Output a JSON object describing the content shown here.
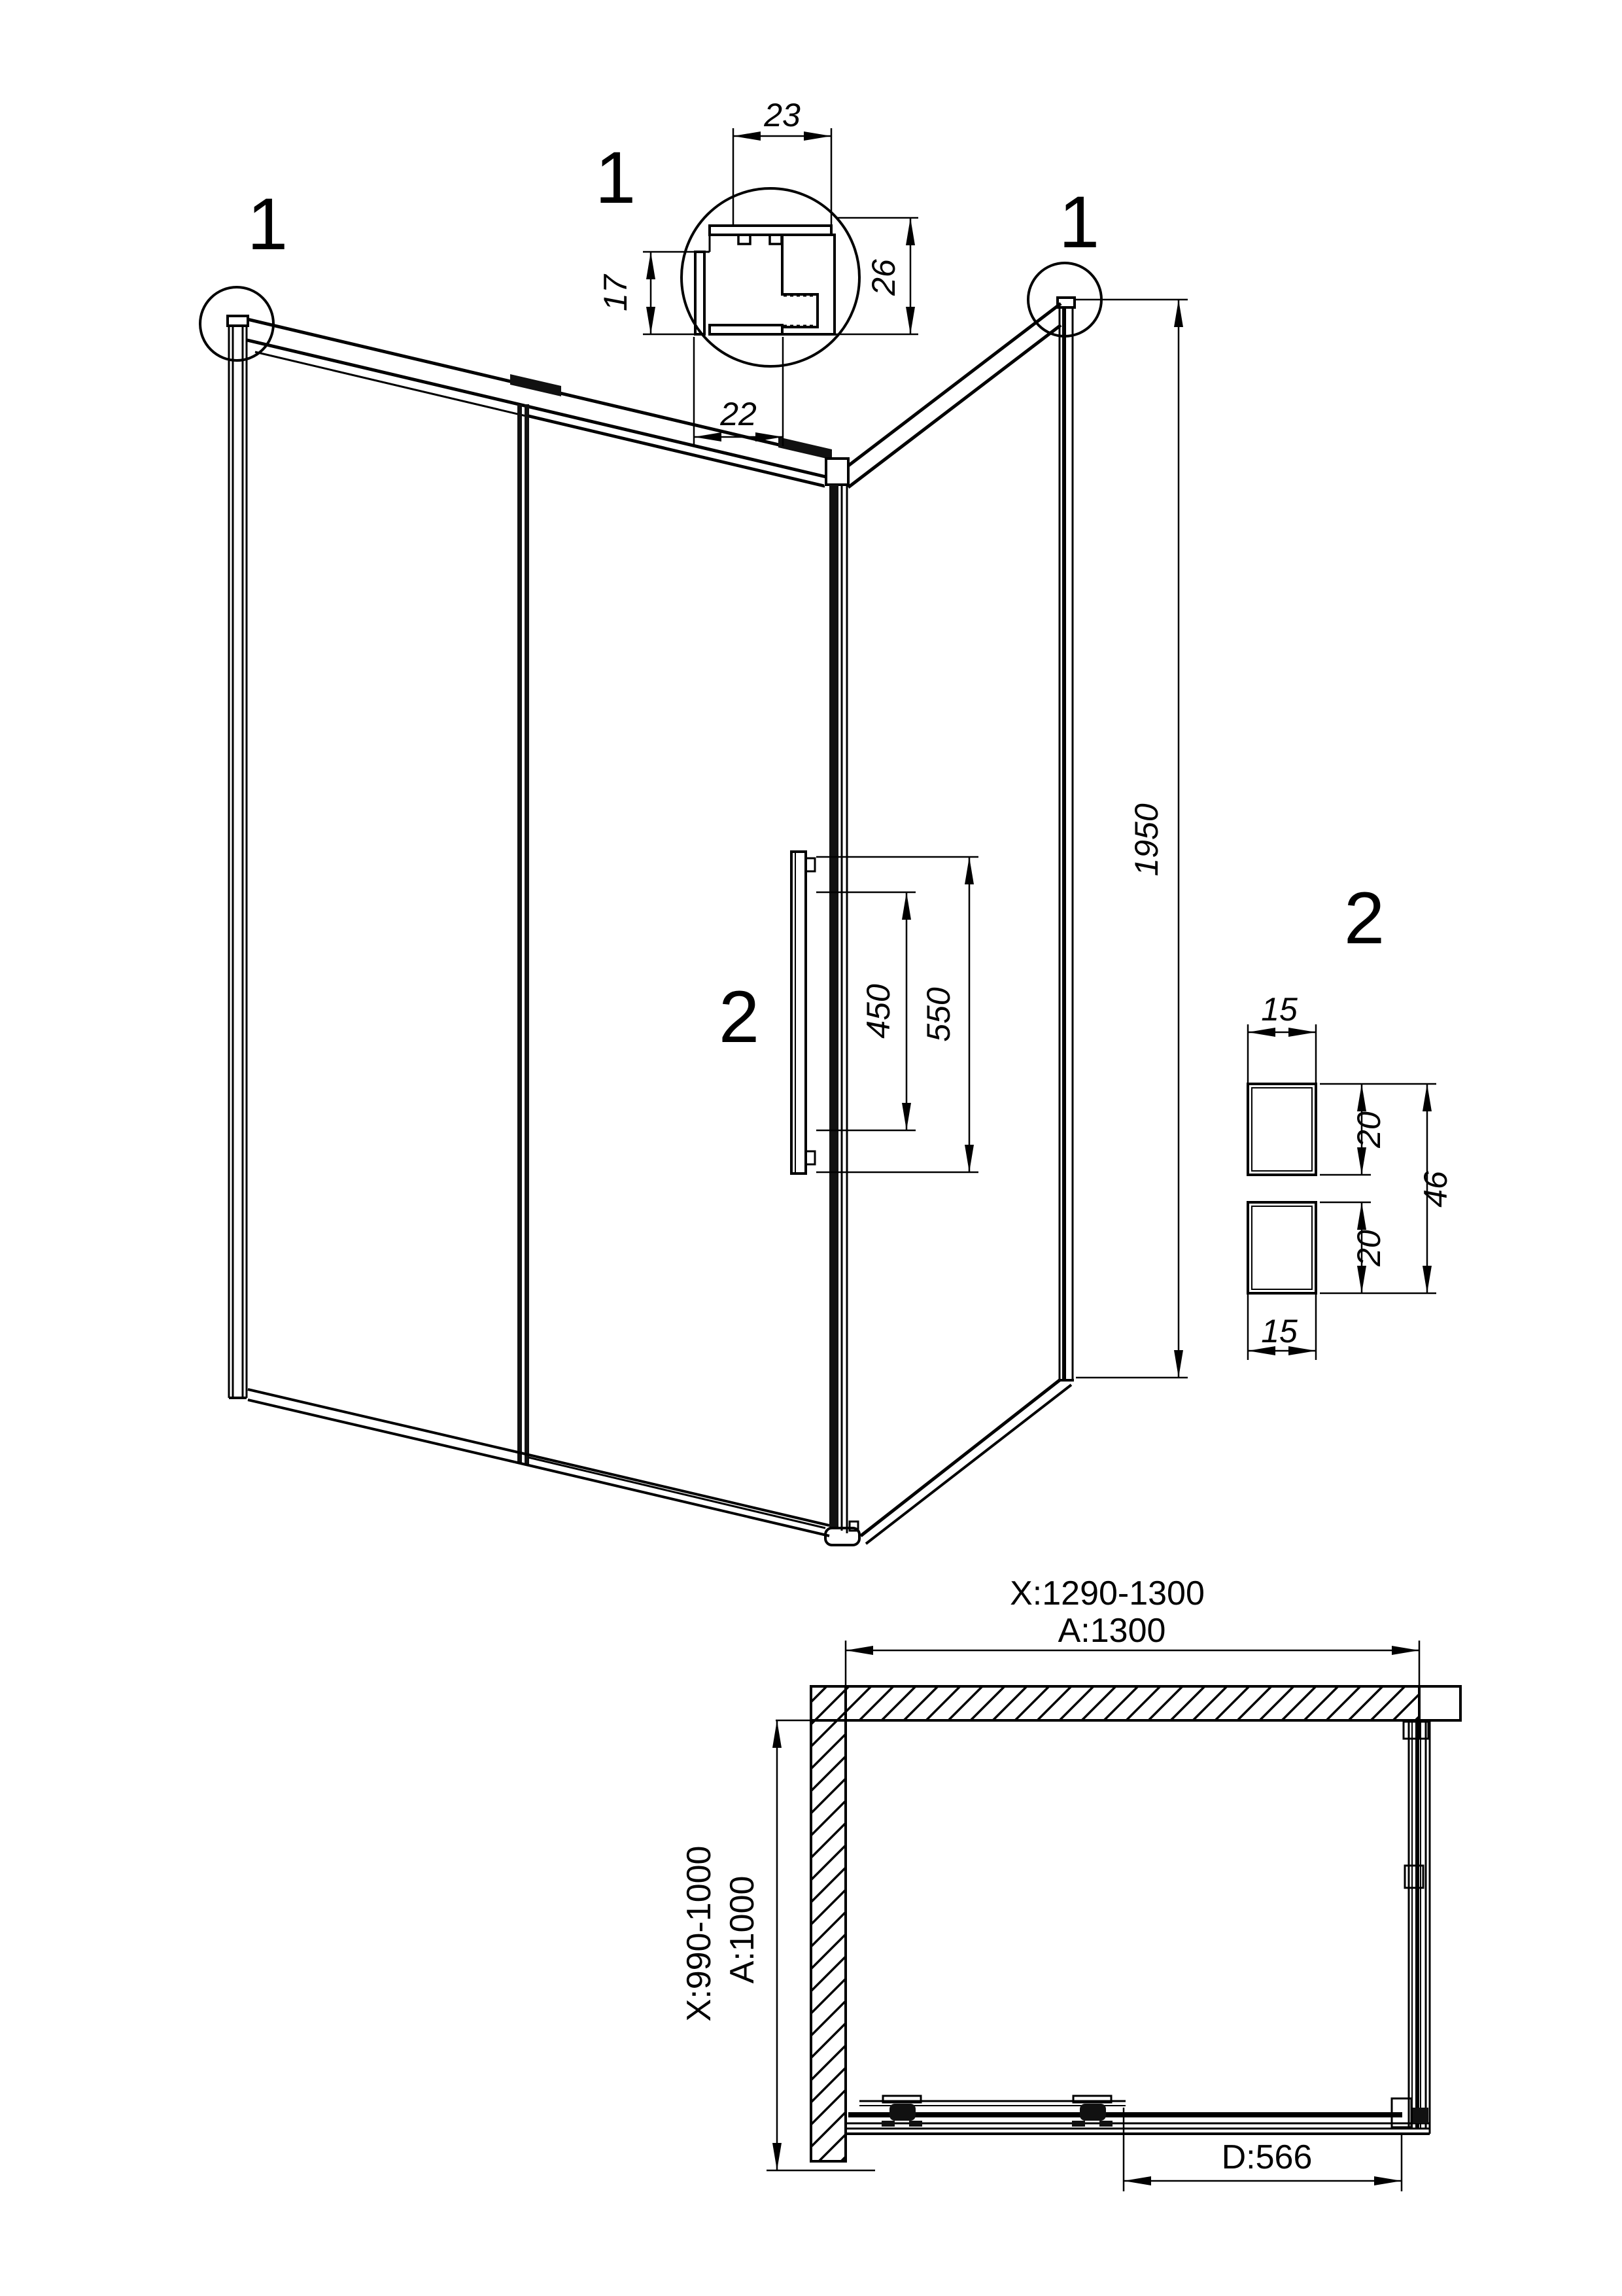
{
  "labels": {
    "detail1_callout": "1",
    "corner_left_marker": "1",
    "corner_right_marker": "1",
    "handle_marker": "2",
    "detail2_callout": "2"
  },
  "dimensions": {
    "profile_top": "23",
    "profile_right": "26",
    "profile_left": "17",
    "profile_bottom": "22",
    "height": "1950",
    "handle_hole_spacing": "450",
    "handle_length": "550",
    "handle_width_top": "15",
    "handle_depth_top": "20",
    "handle_total_depth": "46",
    "handle_depth_bottom": "20",
    "handle_width_bottom": "15",
    "plan_width_range": "X:1290-1300",
    "plan_width": "A:1300",
    "plan_depth_range": "X:990-1000",
    "plan_depth": "A:1000",
    "door_width": "D:566"
  },
  "colors": {
    "line": "#000000",
    "background": "#ffffff"
  }
}
